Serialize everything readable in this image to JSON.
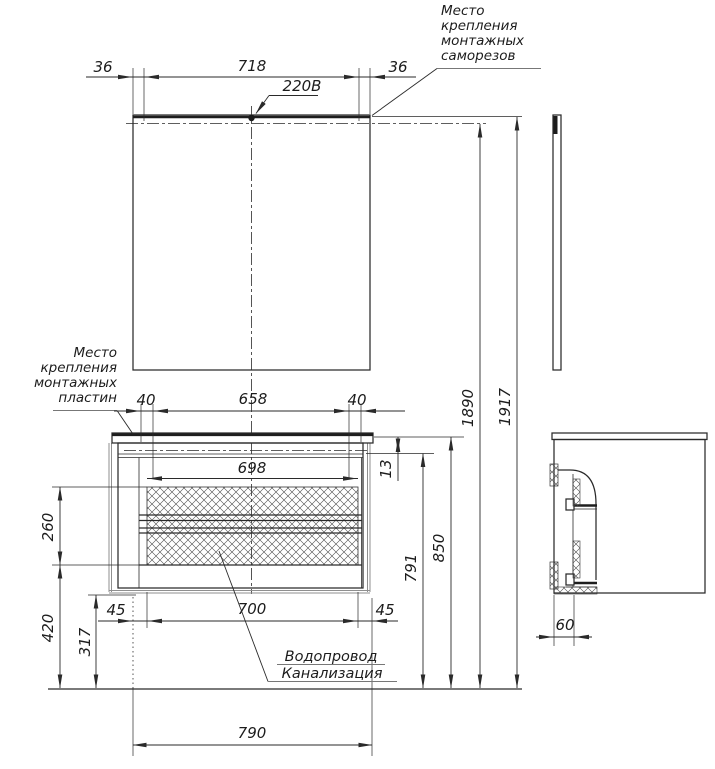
{
  "notes": {
    "screws": {
      "lines": [
        "Место",
        "крепления",
        "монтажных",
        "саморезов"
      ]
    },
    "plates": {
      "lines": [
        "Место",
        "крепления",
        "монтажных",
        "пластин"
      ]
    },
    "power": "220В",
    "plumbing": {
      "lines": [
        "Водопровод",
        "Канализация"
      ]
    }
  },
  "dims": {
    "mirror_left_offset": "36",
    "mirror_screw_span": "718",
    "mirror_right_offset": "36",
    "plate_left_offset": "40",
    "plate_span": "658",
    "plate_right_offset": "40",
    "inner_width": "698",
    "counter_gap": "13",
    "drawers_height": "260",
    "legs_zone_height": "420",
    "trap_height": "317",
    "bottom_left_offset": "45",
    "body_width": "700",
    "bottom_right_offset": "45",
    "overall_width": "790",
    "body_top_height": "791",
    "counter_height": "850",
    "mirror_mount_height": "1890",
    "overall_height": "1917",
    "side_offset": "60"
  }
}
